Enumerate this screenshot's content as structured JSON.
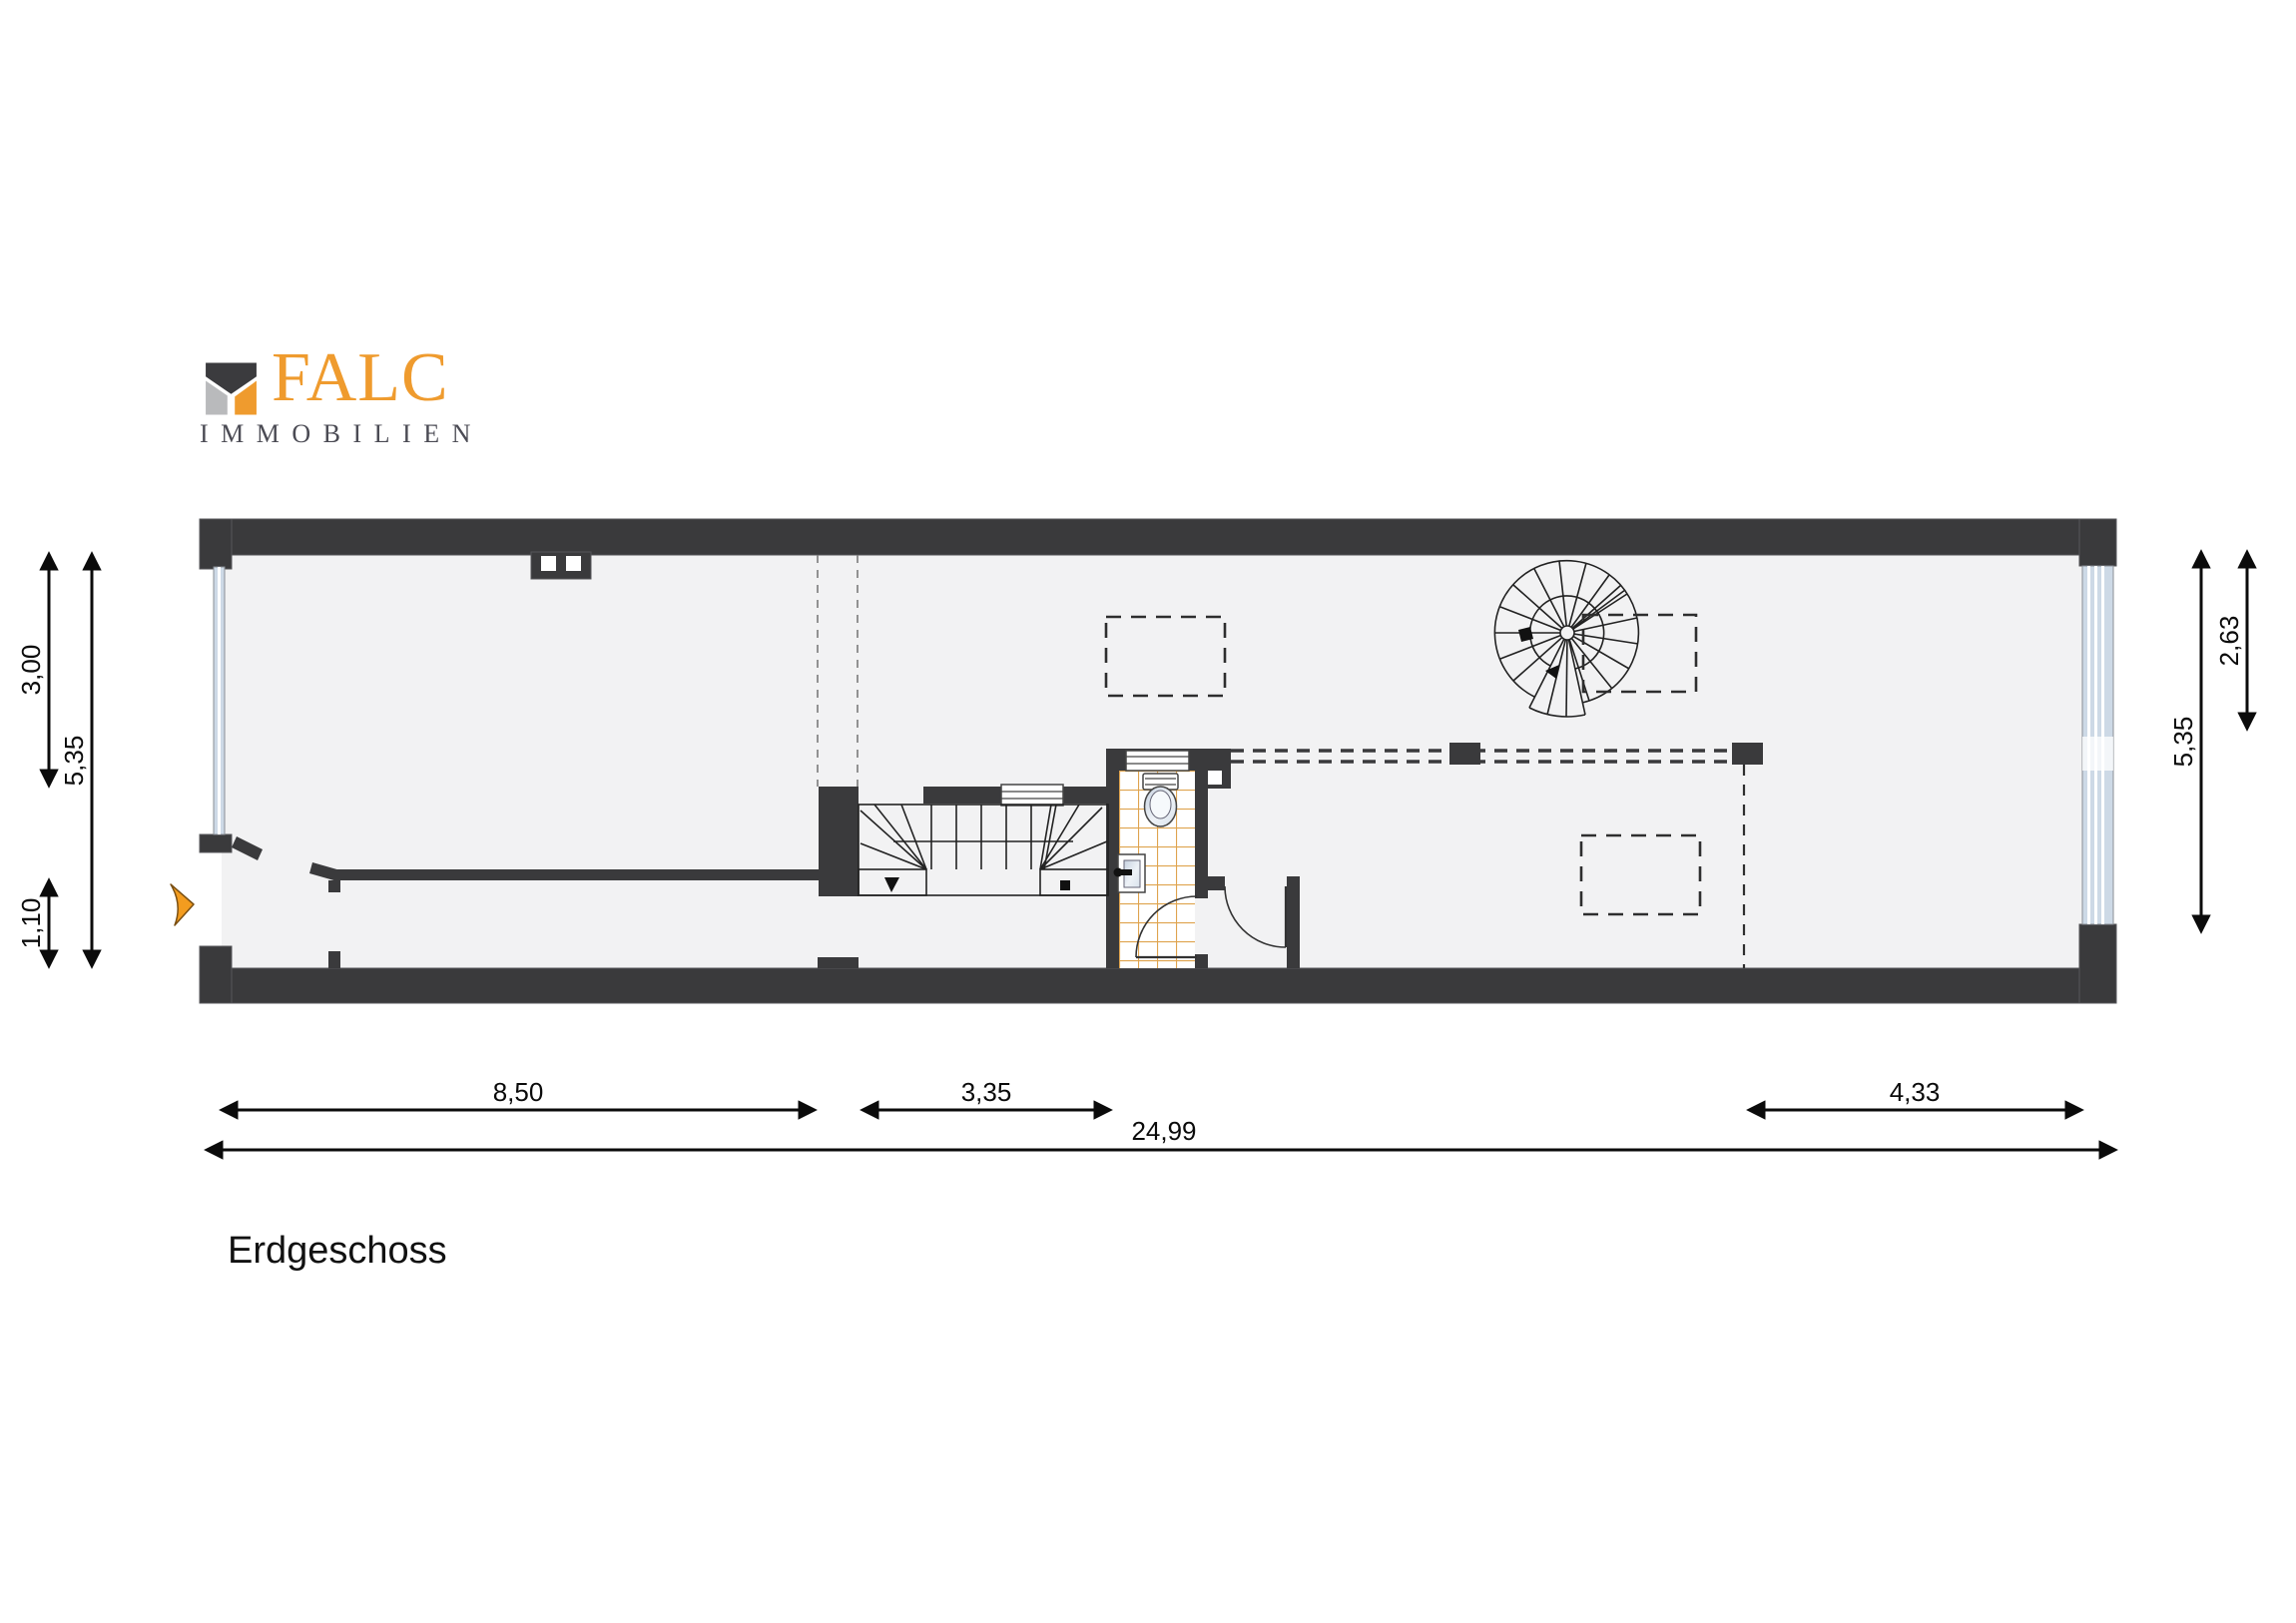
{
  "brand": {
    "name": "FALC",
    "subtitle": "IMMOBILIEN"
  },
  "floor_label": "Erdgeschoss",
  "dimensions": {
    "left": [
      {
        "label": "3,00"
      },
      {
        "label": "5,35"
      },
      {
        "label": "1,10"
      }
    ],
    "right": [
      {
        "label": "5,35"
      },
      {
        "label": "2,63"
      }
    ],
    "bottom": [
      {
        "label": "8,50"
      },
      {
        "label": "3,35"
      },
      {
        "label": "4,33"
      },
      {
        "label": "24,99"
      }
    ]
  },
  "symbols": [
    "entrance-arrow",
    "spiral-staircase",
    "u-staircase",
    "toilet",
    "sink",
    "radiator",
    "door-swing",
    "tiled-floor",
    "window-glazing",
    "chimney-vent"
  ],
  "colors": {
    "wall": "#3A3A3C",
    "floor": "#F2F2F3",
    "tile_grid": "#DFA44F",
    "window_glass": "#CDD9E6",
    "accent_orange": "#F09B2E",
    "logo_orange": "#EF9B2E",
    "logo_gray": "#B9BABC",
    "text": "#111111"
  }
}
